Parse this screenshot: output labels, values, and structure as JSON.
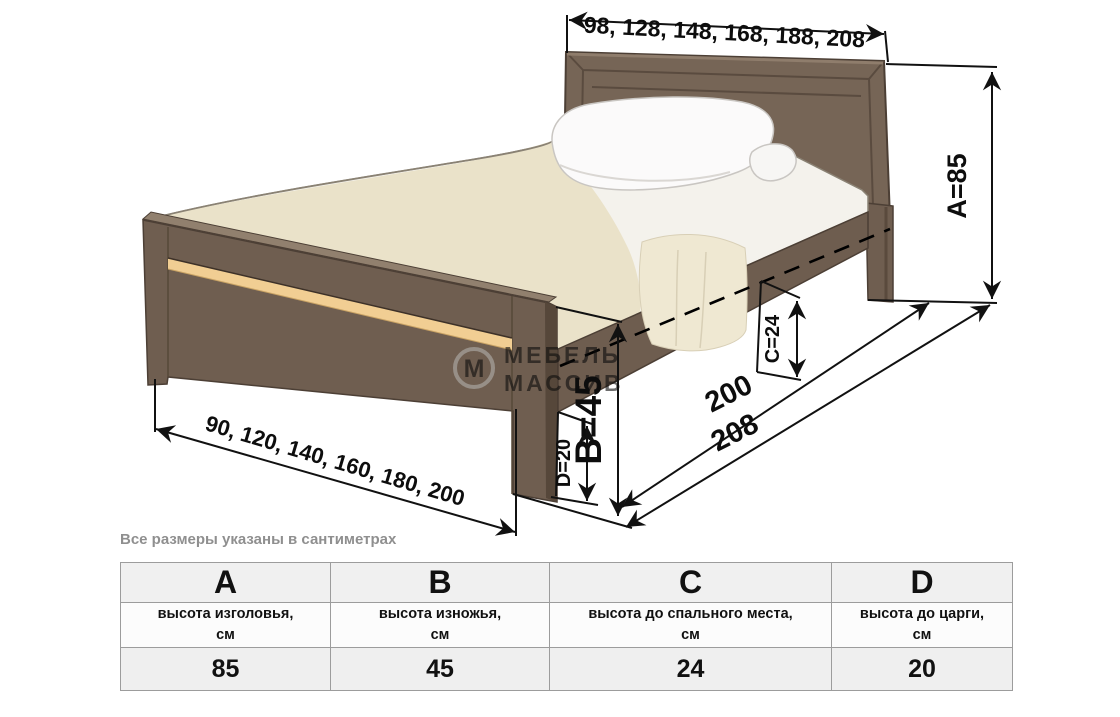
{
  "diagram": {
    "headboard_width_options": "98, 128, 148, 168, 188, 208",
    "bed_width_options": "90, 120, 140, 160, 180, 200",
    "height_headboard": "А=85",
    "height_footboard": "В=45",
    "height_sleeping_surface": "С=24",
    "height_rail": "D=20",
    "length_sleeping": "200",
    "length_overall": "208",
    "note": "Все размеры указаны в сантиметрах",
    "watermark": {
      "logo_letter": "М",
      "line1": "МЕБЕЛЬ",
      "line2": "МАССИВ"
    }
  },
  "table": {
    "columns": [
      {
        "letter": "A",
        "desc": "высота изголовья,",
        "unit": "см",
        "value": "85"
      },
      {
        "letter": "B",
        "desc": "высота изножья,",
        "unit": "см",
        "value": "45"
      },
      {
        "letter": "C",
        "desc": "высота до спального места,",
        "unit": "см",
        "value": "24"
      },
      {
        "letter": "D",
        "desc": "высота до царги,",
        "unit": "см",
        "value": "20"
      }
    ]
  },
  "colors": {
    "wood": "#6f5e50",
    "wood_dark": "#4c3f35",
    "accent_strip": "#f1ce93",
    "blanket": "#eae2c9",
    "dimension_line": "#111111"
  }
}
